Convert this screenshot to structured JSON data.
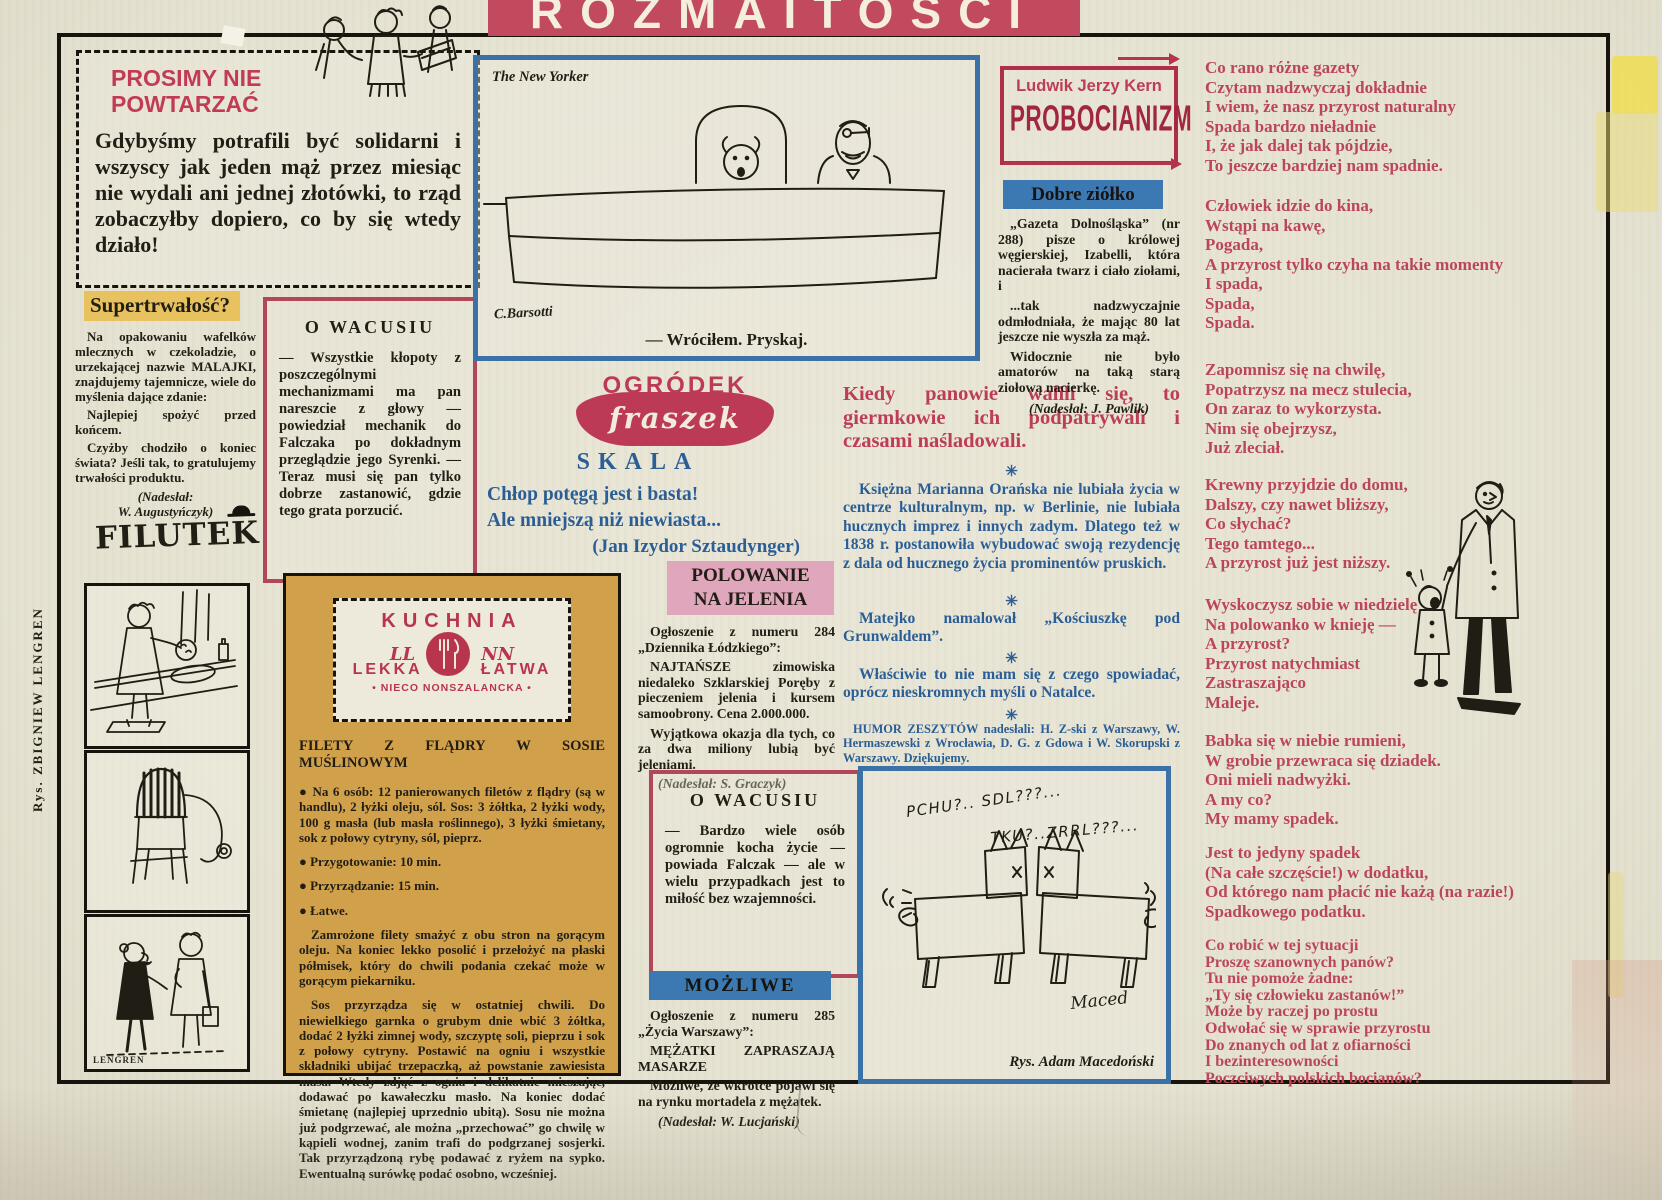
{
  "banner": {
    "title": "ROZMAITOŚCI"
  },
  "prosimy": {
    "heading": "PROSIMY NIE\nPOWTARZAĆ",
    "body": "Gdybyśmy potrafili być solidarni i wszyscy jak jeden mąż przez miesiąc nie wydali ani jednej złotówki, to rząd zobaczyłby dopiero, co by się wtedy działo!"
  },
  "super": {
    "heading": "Supertrwałość?",
    "p1": "Na opakowaniu wafelków mlecznych w czekoladzie, o urzekającej nazwie MALAJKI, znajdujemy tajemnicze, wiele do myślenia dające zdanie:",
    "p2": "Najlepiej spożyć przed końcem.",
    "p3": "Czyżby chodziło o koniec świata? Jeśli tak, to gratulujemy trwałości produktu.",
    "note": "(Nadesłał:\nW. Augustyńczyk)"
  },
  "wacusiu1": {
    "heading": "O WACUSIU",
    "body": "— Wszystkie kłopoty z poszczególnymi mechanizmami ma pan nareszcie z głowy — powiedział mechanik do Falczaka po dokładnym przeglądzie jego Syrenki. — Teraz musi się pan tylko dobrze zastanowić, gdzie tego grata porzucić."
  },
  "filutek": {
    "title": "FILUTEK",
    "credit": "Rys.  ZBIGNIEW  LENGREN",
    "signature": "LENGREN"
  },
  "ny": {
    "label": "The New Yorker",
    "signature": "C.Barsotti",
    "caption": "— Wróciłem. Pryskaj."
  },
  "ogrodek": {
    "logo_top": "OGRÓDEK",
    "logo_bottom": "fraszek",
    "title": "SKALA",
    "lines": "Chłop potęgą jest i basta!\nAle mniejszą niż niewiasta...",
    "author": "(Jan Izydor Sztaudynger)"
  },
  "polowanie": {
    "heading": "POLOWANIE\nNA JELENIA",
    "p1": "Ogłoszenie z numeru 284 „Dziennika Łódzkiego”:",
    "p2_bold": "NAJTAŃSZE",
    "p2_rest": " zimowiska niedaleko Szklarskiej Poręby z pieczeniem jelenia i kursem samoobrony. Cena 2.000.000.",
    "p3": "Wyjątkowa okazja dla tych, co za dwa miliony lubią być jeleniami.",
    "note": "(Nadesłał: S. Graczyk)"
  },
  "wacusiu2": {
    "heading": "O WACUSIU",
    "body": "— Bardzo wiele osób ogromnie kocha życie — powiada Falczak — ale w wielu przypadkach jest to miłość bez wzajemności."
  },
  "mozliwe": {
    "heading": "MOŻLIWE",
    "p1": "Ogłoszenie z numeru 285 „Życia Warszawy”:",
    "p2": "MĘŻATKI ZAPRASZAJĄ MASARZE",
    "p3": "Możliwe, że wkrótce pojawi się na rynku mortadela z mężatek.",
    "note": "(Nadesłał: W. Lucjański)"
  },
  "kuchnia": {
    "logo_title": "KUCHNIA",
    "logo_ll": "LL",
    "logo_nn": "NN",
    "logo_left": "LEKKA",
    "logo_right": "ŁATWA",
    "logo_sub": "• NIECO NONSZALANCKA •",
    "recipe_title": "FILETY Z FLĄDRY W SOSIE MUŚLINOWYM",
    "bullets": [
      "● Na 6 osób: 12 panierowanych filetów z flądry (są w handlu), 2 łyżki oleju, sól. Sos: 3 żółtka, 2 łyżki wody, 100 g masła (lub masła roślinnego), 3 łyżki śmietany, sok z połowy cytryny, sól, pieprz.",
      "● Przygotowanie: 10 min.",
      "● Przyrządzanie: 15 min.",
      "● Łatwe."
    ],
    "p1": "Zamrożone filety smażyć z obu stron na gorącym oleju. Na koniec lekko posolić i przełożyć na płaski półmisek, który do chwili podania czekać może w gorącym piekarniku.",
    "p2": "Sos przyrządza się w ostatniej chwili. Do niewielkiego garnka o grubym dnie wbić 3 żółtka, dodać 2 łyżki zimnej wody, szczyptę soli, pieprzu i sok z połowy cytryny. Postawić na ogniu i wszystkie składniki ubijać trzepaczką, aż powstanie zawiesista masa. Wtedy zdjąć z ognia i delikatnie mieszając, dodawać po kawałeczku masło. Na koniec dodać śmietanę (najlepiej uprzednio ubitą). Sosu nie można już podgrzewać, ale można „przechować” go chwilę w kąpieli wodnej, zanim trafi do podgrzanej sosjerki. Tak przyrządzoną rybę podawać z ryżem na sypko. Ewentualną surówkę podać osobno, wcześniej."
  },
  "humor": {
    "heading": "Kiedy panowie walili się, to giermkowie ich podpatrywali i czasami naśladowali.",
    "sep": "✳",
    "p1": "Księżna Marianna Orańska nie lubiała życia w centrze kulturalnym, np. w Berlinie, nie lubiała hucznych imprez i innych zadym. Dlatego też w 1838 r. postanowiła wybudować swoją rezydencję z dala od hucznego życia prominentów pruskich.",
    "p2": "Matejko namalował „Kościuszkę pod Grunwaldem”.",
    "p3": "Właściwie to nie mam się z czego spowiadać, oprócz nieskromnych myśli o Natalce.",
    "credits": "HUMOR ZESZYTÓW nadesłali: H. Z-ski z Warszawy, W. Hermaszewski z Wrocławia, D. G. z Gdowa i W. Skorupski z Warszawy. Dziękujemy."
  },
  "maced": {
    "speech1": "PCHU?.. SDL???...",
    "speech2": "TKU?..ZRRL???...",
    "signature": "Maced",
    "caption": "Rys. Adam Macedoński"
  },
  "kern": {
    "author": "Ludwik Jerzy Kern",
    "title": "PROBOCIANIZM"
  },
  "ziolko": {
    "heading": "Dobre ziółko",
    "p1": "„Gazeta Dolnośląska” (nr 288) pisze o królowej węgierskiej, Izabelli, która nacierała twarz i ciało ziołami, i",
    "p2": "...tak nadzwyczajnie odmłodniała, że mając 80 lat jeszcze nie wyszła za mąż.",
    "p3": "Widocznie nie było amatorów na taką starą ziołową nacierkę.",
    "note": "(Nadesłał: J. Pawlik)"
  },
  "poem": {
    "stanzas": [
      "Co rano różne gazety\nCzytam nadzwyczaj dokładnie\nI wiem, że nasz przyrost naturalny\nSpada bardzo nieładnie\nI, że jak dalej tak pójdzie,\nTo jeszcze bardziej nam spadnie.",
      "Człowiek idzie do kina,\nWstąpi na kawę,\nPogada,\nA przyrost tylko czyha na takie momenty\nI spada,\nSpada,\nSpada.",
      "Zapomnisz się na chwilę,\nPopatrzysz na mecz stulecia,\nOn zaraz to wykorzysta.\nNim się obejrzysz,\nJuż zleciał.",
      "Krewny przyjdzie do domu,\nDalszy, czy nawet bliższy,\nCo słychać?\nTego tamtego...\nA przyrost już jest niższy.",
      "Wyskoczysz sobie w niedzielę\nNa polowanko w knieję —\nA przyrost?\nPrzyrost natychmiast\nZastraszająco\nMaleje.",
      "Babka się w niebie rumieni,\nW grobie przewraca się dziadek.\nOni mieli nadwyżki.\nA my co?\nMy mamy spadek.",
      "Jest to jedyny spadek\n(Na całe szczęście!) w dodatku,\nOd którego nam płacić nie każą (na razie!)\nSpadkowego podatku.",
      "Co robić w tej sytuacji\nProszę szanownych panów?\nTu nie pomoże żadne:\n„Ty się człowieku zastanów!”\nMoże by raczej po prostu\nOdwołać się w sprawie przyrostu\nDo znanych od lat z ofiarności\nI bezinteresowności\nPoczciwych polskich bocianów?"
    ]
  },
  "colors": {
    "paper": "#e7e4d4",
    "red_accent": "#bc3d55",
    "dark_red": "#a02641",
    "blue_border": "#3a72a8",
    "blue_text": "#2b5e95",
    "blue_bar": "#3c78b2",
    "pink_bar": "#e0a6bc",
    "yellow_highlight": "#e8c25f",
    "tan_box": "#d1a04b",
    "ink": "#201d14"
  }
}
